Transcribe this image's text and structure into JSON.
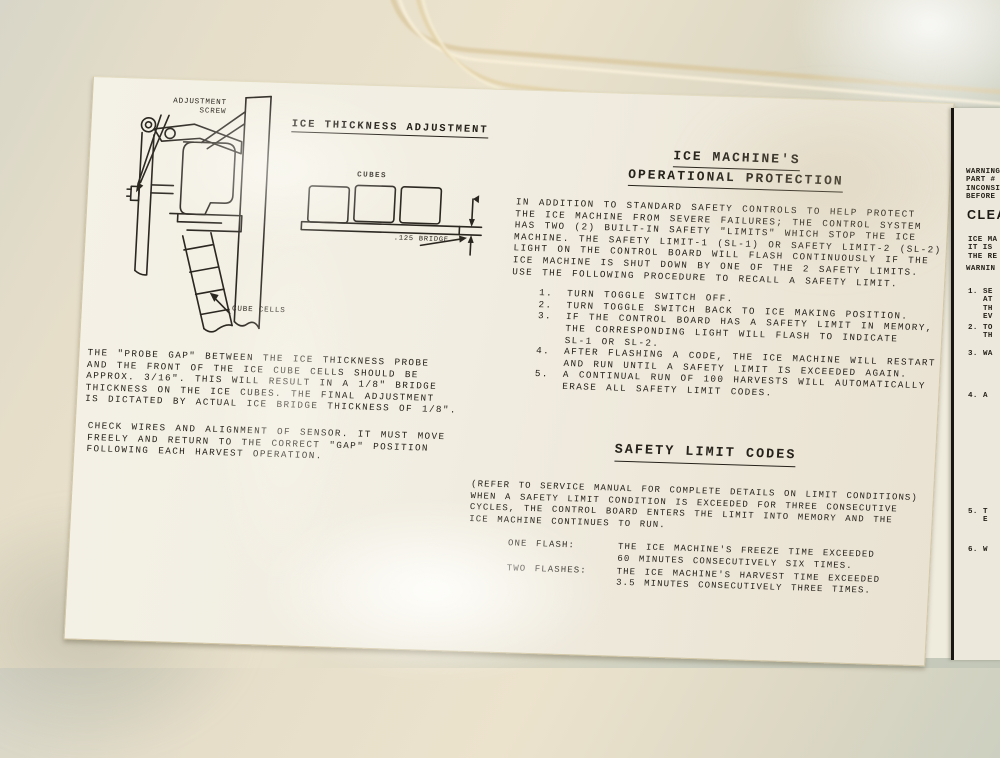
{
  "colors": {
    "ink": "#26221b",
    "label_background": "#f1ede1",
    "panel_cream": "#ece3cd",
    "panel_gray_green": "#c4c8b9",
    "divider_line": "#181512"
  },
  "thickness_section": {
    "heading": "ICE THICKNESS ADJUSTMENT",
    "adjustment_screw_label": "ADJUSTMENT\nSCREW",
    "cube_cells_label": "CUBE CELLS",
    "cubes_label": "CUBES",
    "bridge_dimension_label": ".125 BRIDGE",
    "probe_gap_paragraph": "THE \"PROBE GAP\" BETWEEN THE ICE THICKNESS PROBE\nAND THE FRONT OF THE ICE CUBE CELLS SHOULD BE\nAPPROX. 3/16\". THIS WILL RESULT IN A 1/8\" BRIDGE\nTHICKNESS ON THE ICE CUBES. THE FINAL ADJUSTMENT\nIS DICTATED BY ACTUAL ICE BRIDGE THICKNESS OF 1/8\".",
    "check_wires_paragraph": "CHECK WIRES AND ALIGNMENT OF SENSOR.  IT MUST MOVE\nFREELY AND RETURN TO THE CORRECT \"GAP\" POSITION\nFOLLOWING EACH HARVEST OPERATION."
  },
  "protection_section": {
    "heading_line1": "ICE MACHINE'S",
    "heading_line2": "OPERATIONAL PROTECTION",
    "intro": "IN ADDITION TO STANDARD SAFETY CONTROLS TO HELP PROTECT\nTHE ICE MACHINE FROM SEVERE FAILURES; THE CONTROL SYSTEM\nHAS TWO (2) BUILT-IN SAFETY \"LIMITS\" WHICH STOP THE ICE\nMACHINE.  THE SAFETY LIMIT-1 (SL-1) OR SAFETY LIMIT-2 (SL-2)\nLIGHT ON THE CONTROL BOARD WILL FLASH CONTINUOUSLY IF THE\nICE MACHINE IS SHUT DOWN BY ONE OF THE 2 SAFETY LIMITS.\nUSE THE FOLLOWING PROCEDURE TO RECALL A SAFETY LIMIT.",
    "steps": [
      {
        "num": "1.",
        "text": "TURN TOGGLE SWITCH OFF."
      },
      {
        "num": "2.",
        "text": "TURN TOGGLE SWITCH BACK TO ICE MAKING POSITION."
      },
      {
        "num": "3.",
        "text": "IF THE CONTROL BOARD HAS A SAFETY LIMIT IN MEMORY,\nTHE CORRESPONDING LIGHT WILL FLASH TO INDICATE\nSL-1 OR SL-2."
      },
      {
        "num": "4.",
        "text": "AFTER FLASHING A CODE, THE ICE MACHINE WILL RESTART\nAND RUN UNTIL A SAFETY LIMIT IS EXCEEDED AGAIN."
      },
      {
        "num": "5.",
        "text": "A CONTINUAL RUN OF 100 HARVESTS WILL AUTOMATICALLY\nERASE ALL SAFETY LIMIT CODES."
      }
    ]
  },
  "codes_section": {
    "heading": "SAFETY LIMIT CODES",
    "intro": "(REFER TO SERVICE MANUAL FOR COMPLETE DETAILS ON LIMIT CONDITIONS)\nWHEN A SAFETY LIMIT CONDITION IS EXCEEDED FOR THREE CONSECUTIVE\nCYCLES, THE CONTROL BOARD ENTERS THE LIMIT INTO MEMORY AND THE\nICE MACHINE CONTINUES TO RUN.",
    "codes": [
      {
        "label": "ONE FLASH:",
        "description": "THE ICE MACHINE'S FREEZE TIME EXCEEDED\n60 MINUTES CONSECUTIVELY SIX TIMES."
      },
      {
        "label": "TWO FLASHES:",
        "description": "THE ICE MACHINE'S HARVEST TIME EXCEEDED\n3.5 MINUTES CONSECUTIVELY THREE TIMES."
      }
    ]
  },
  "right_label": {
    "warning_fragment": "WARNING\nPART # -\nINCONSIS\nBEFORE",
    "clean_fragment": "CLEA",
    "intro_fragment": "ICE MA\nIT IS\nTHE RE",
    "warning2_fragment": "WARNIN",
    "items": [
      {
        "num": "1.",
        "text": "SE\nAT\nTH\nEV"
      },
      {
        "num": "2.",
        "text": "TO\nTH"
      },
      {
        "num": "3.",
        "text": "WA"
      },
      {
        "num": "4.",
        "text": "A"
      },
      {
        "num": "5.",
        "text": "T\nE"
      },
      {
        "num": "6.",
        "text": "W"
      }
    ]
  }
}
